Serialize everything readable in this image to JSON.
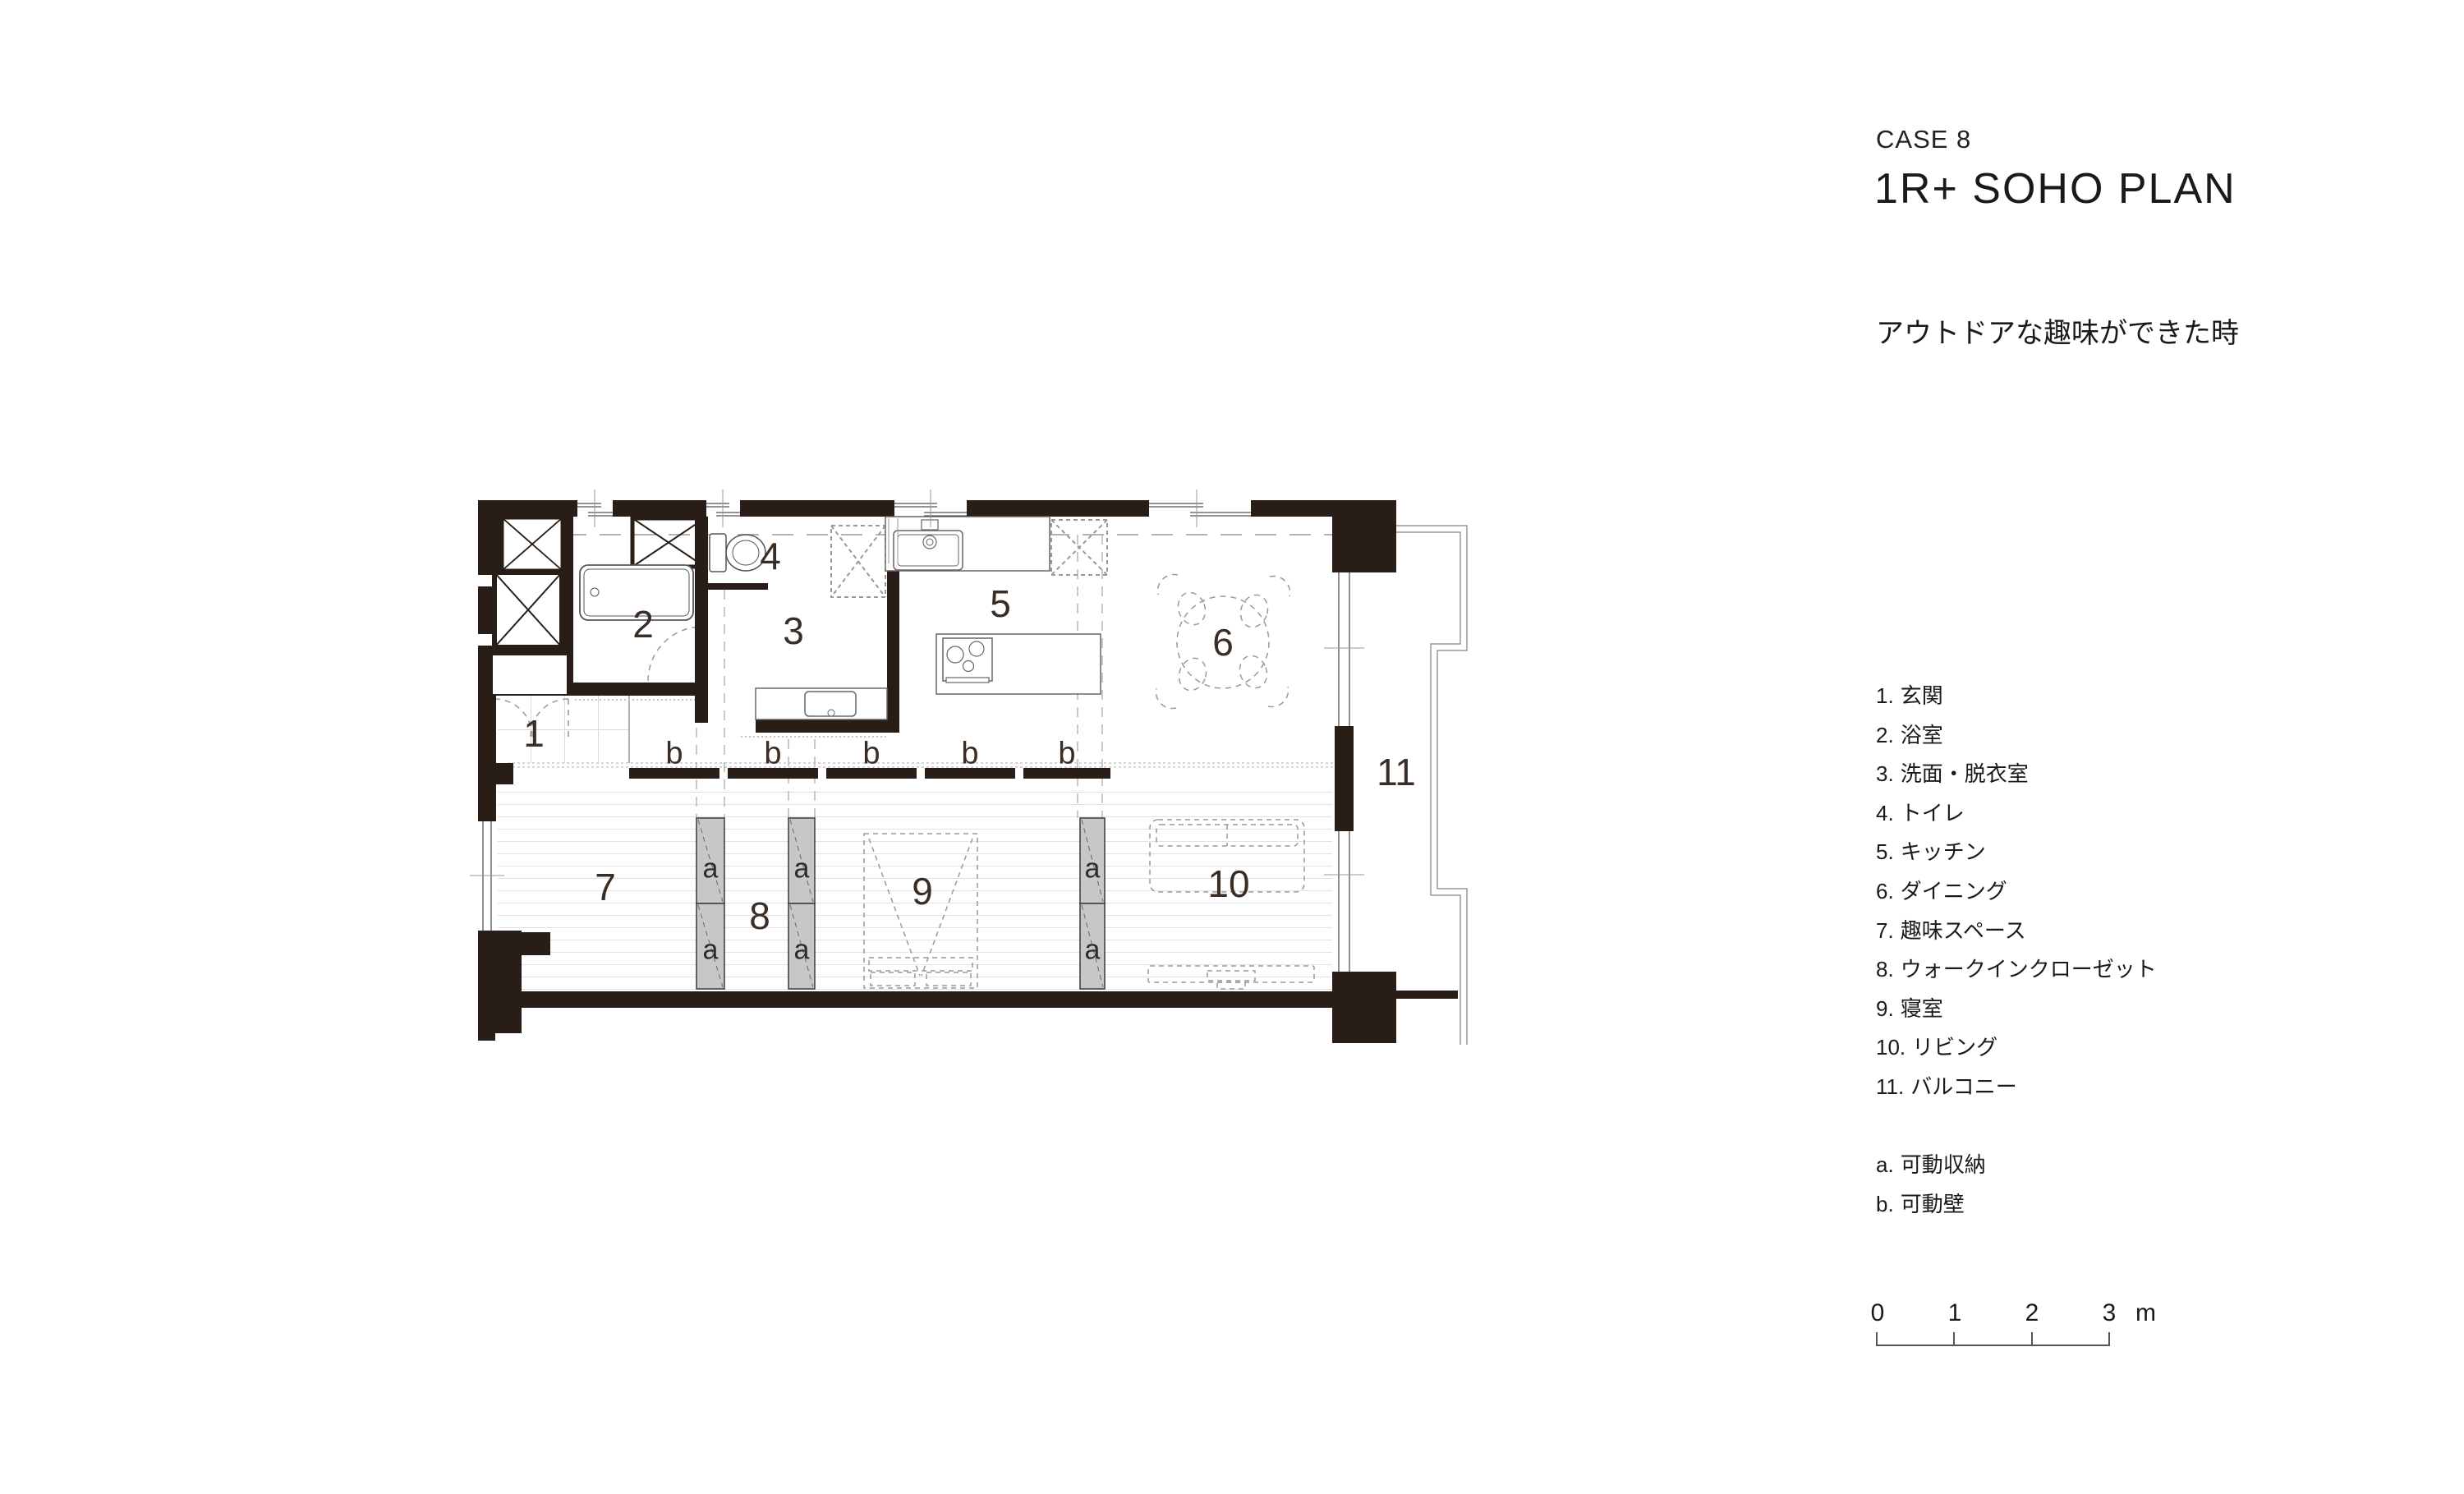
{
  "title": {
    "case_label": "CASE 8",
    "plan_name": "1R+ SOHO PLAN",
    "subtitle": "アウトドアな趣味ができた時"
  },
  "legend": {
    "items": [
      {
        "num": "1.",
        "label": "玄関"
      },
      {
        "num": "2.",
        "label": "浴室"
      },
      {
        "num": "3.",
        "label": "洗面・脱衣室"
      },
      {
        "num": "4.",
        "label": "トイレ"
      },
      {
        "num": "5.",
        "label": "キッチン"
      },
      {
        "num": "6.",
        "label": "ダイニング"
      },
      {
        "num": "7.",
        "label": "趣味スペース"
      },
      {
        "num": "8.",
        "label": "ウォークインクローゼット"
      },
      {
        "num": "9.",
        "label": "寝室"
      },
      {
        "num": "10.",
        "label": "リビング"
      },
      {
        "num": "11.",
        "label": "バルコニー"
      }
    ],
    "sub_items": [
      {
        "num": "a.",
        "label": "可動収納"
      },
      {
        "num": "b.",
        "label": "可動壁"
      }
    ]
  },
  "scale_bar": {
    "ticks": [
      "0",
      "1",
      "2",
      "3"
    ],
    "unit": "m"
  },
  "plan": {
    "rooms": [
      {
        "num": "1"
      },
      {
        "num": "2"
      },
      {
        "num": "3"
      },
      {
        "num": "4"
      },
      {
        "num": "5"
      },
      {
        "num": "6"
      },
      {
        "num": "7"
      },
      {
        "num": "8"
      },
      {
        "num": "9"
      },
      {
        "num": "10"
      },
      {
        "num": "11"
      }
    ],
    "storage_label": "a",
    "movable_wall_label": "b",
    "colors": {
      "wall": "#281e17",
      "room_number": "#3a2d25",
      "movable_storage_fill": "#c7c7c7"
    }
  }
}
